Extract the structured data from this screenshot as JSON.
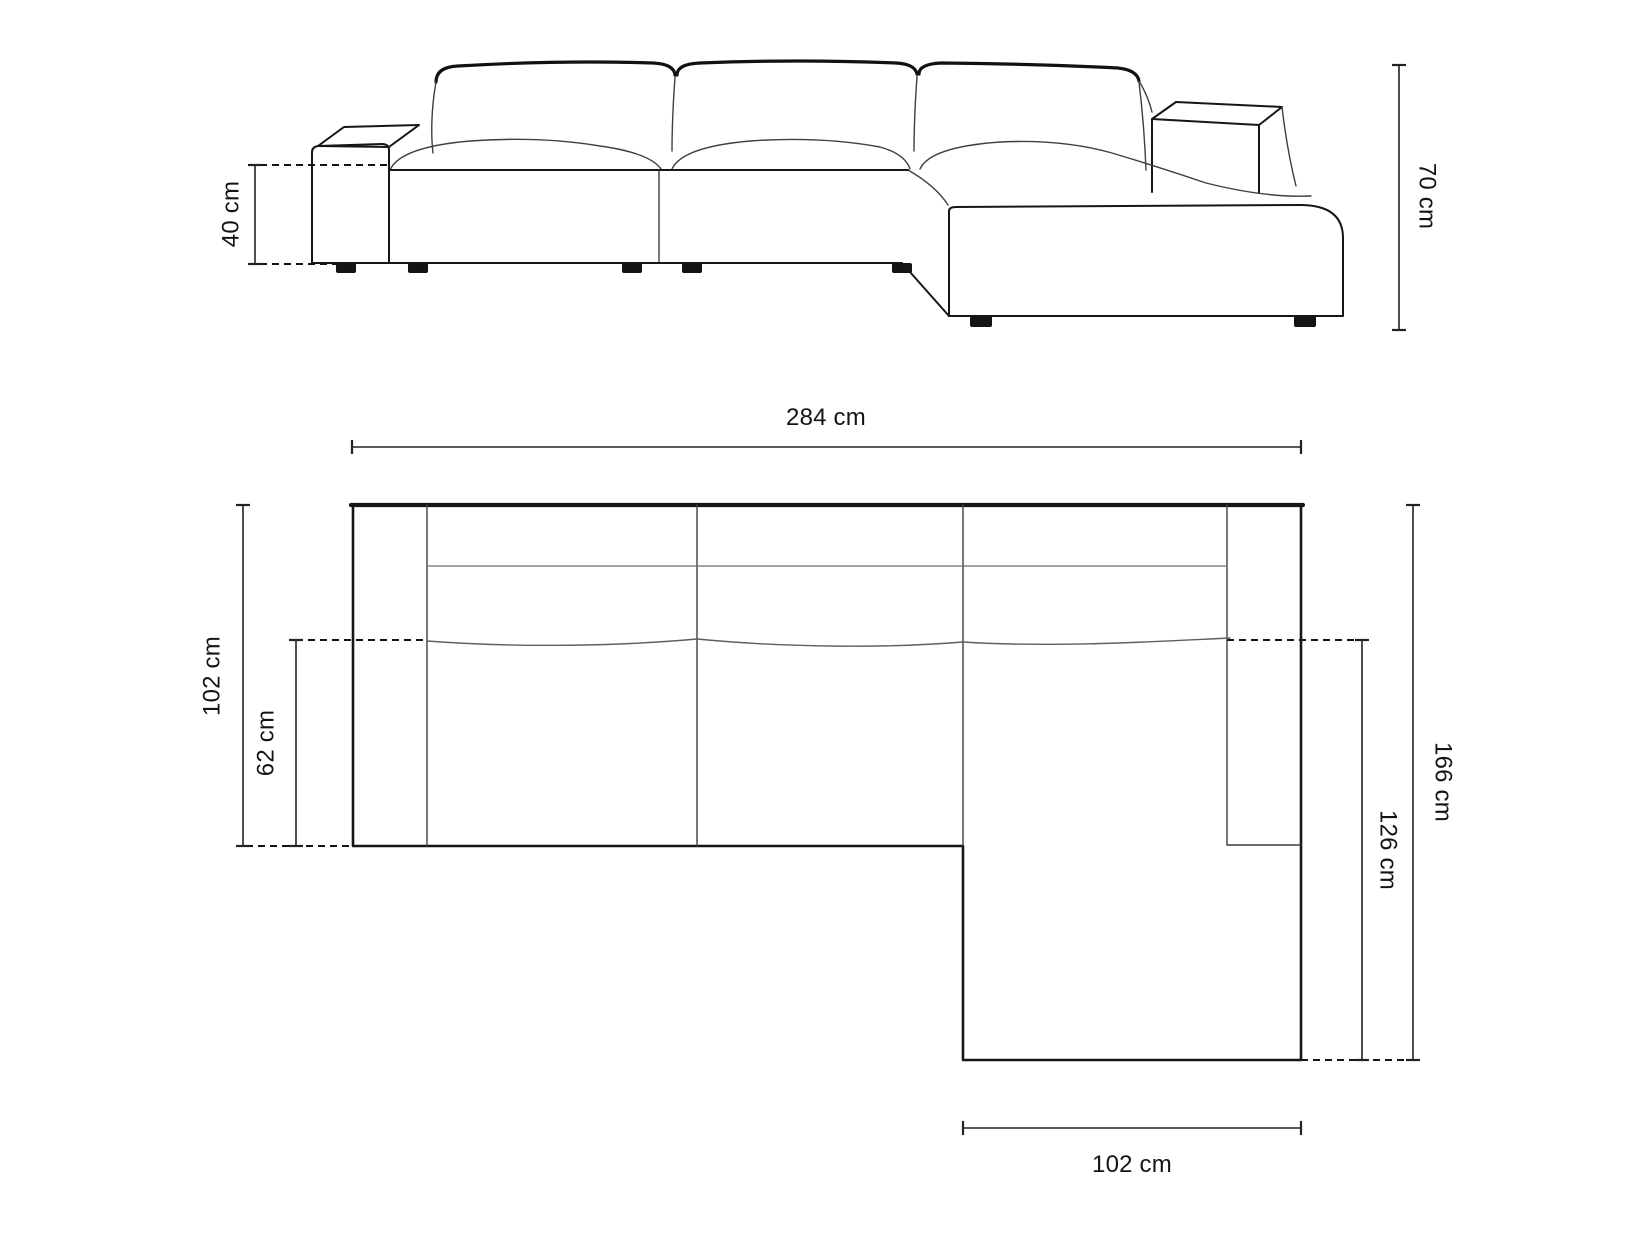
{
  "diagram": {
    "type": "sofa-dimension-drawing",
    "unit": "cm",
    "views": [
      "front-elevation",
      "top-plan"
    ]
  },
  "elevation": {
    "seat_height_label": "40 cm",
    "seat_height_value": 40,
    "overall_height_label": "70 cm",
    "overall_height_value": 70
  },
  "plan": {
    "overall_width_label": "284 cm",
    "overall_width_value": 284,
    "body_depth_label": "102 cm",
    "body_depth_value": 102,
    "seat_depth_label": "62 cm",
    "seat_depth_value": 62,
    "overall_depth_label": "166 cm",
    "overall_depth_value": 166,
    "chaise_depth_label": "126 cm",
    "chaise_depth_value": 126,
    "chaise_width_label": "102 cm",
    "chaise_width_value": 102
  }
}
